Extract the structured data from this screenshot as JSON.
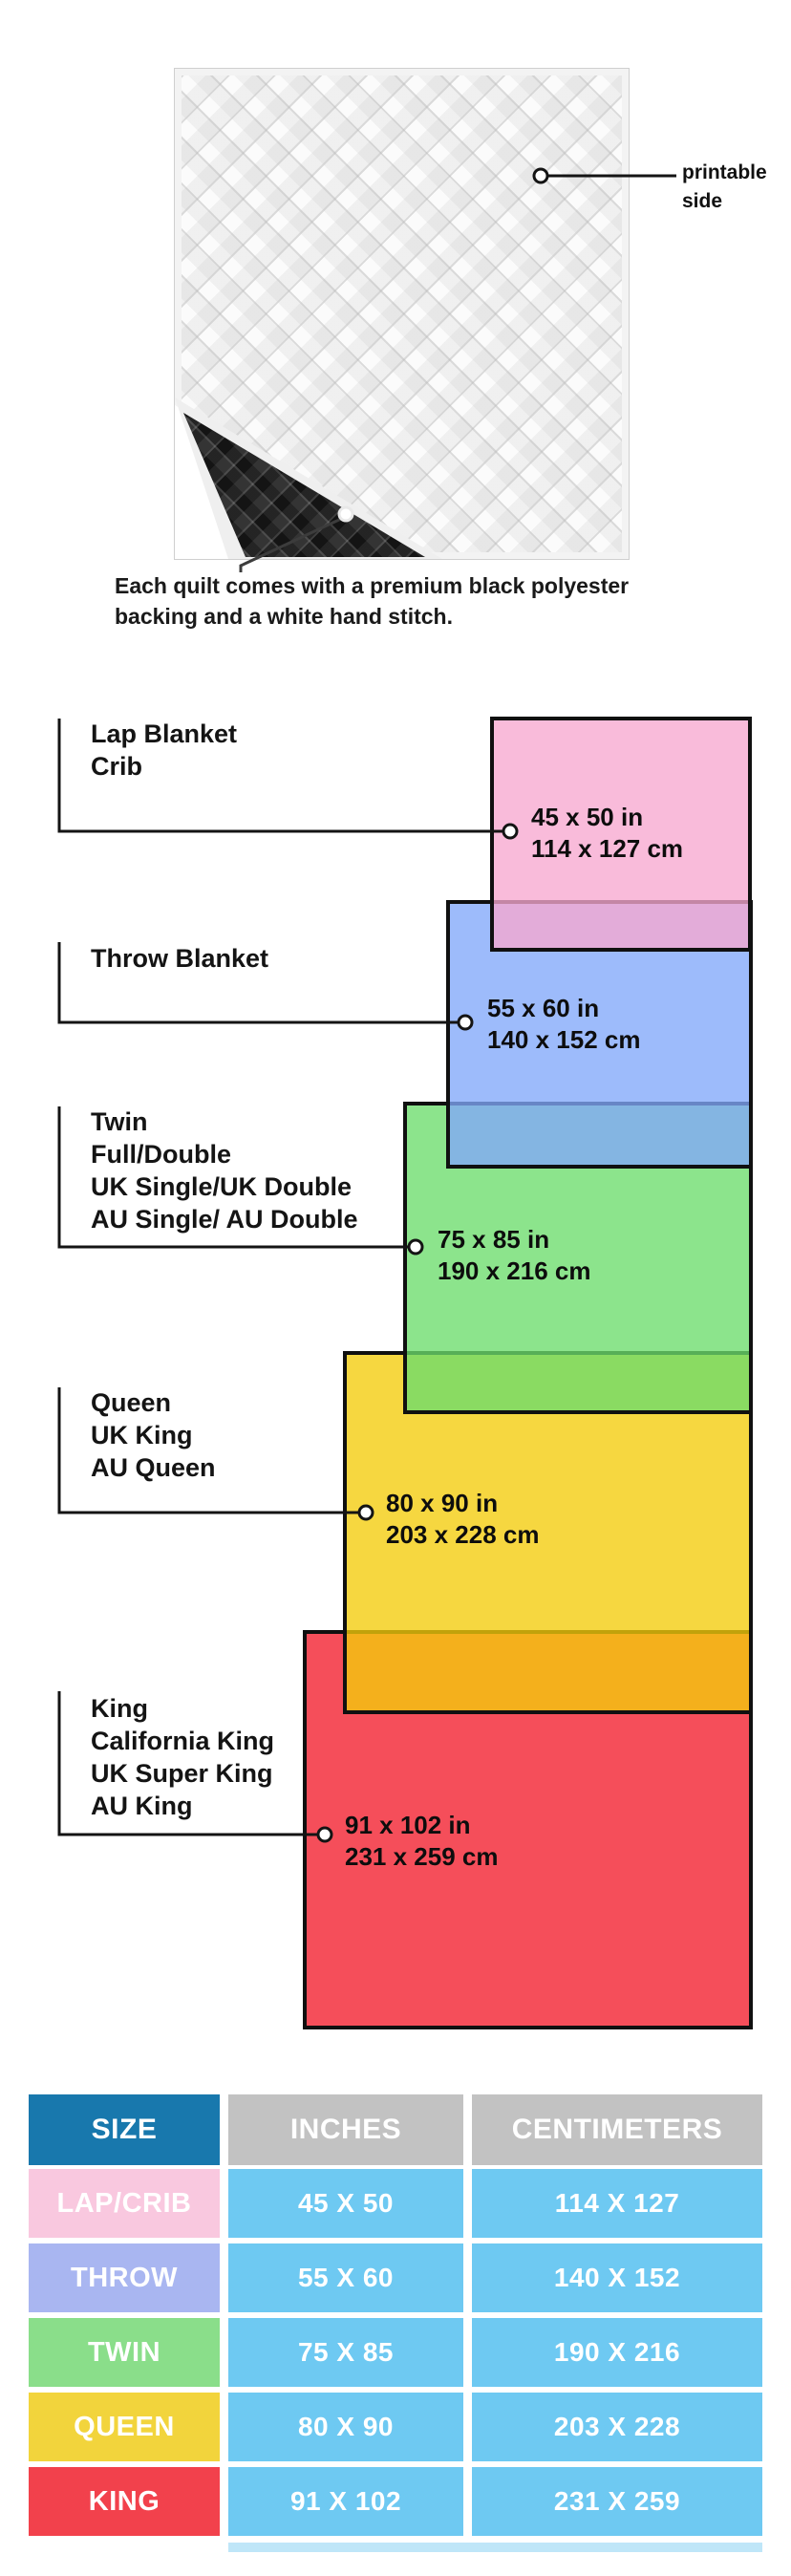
{
  "quilt": {
    "printable_label_line1": "printable",
    "printable_label_line2": "side",
    "caption_line1": "Each quilt comes with a premium black polyester",
    "caption_line2": "backing and a white hand stitch."
  },
  "diagram": {
    "border_color": "#101010",
    "items": [
      {
        "label_lines": [
          "Lap Blanket",
          "Crib"
        ],
        "inches": "45 x 50 in",
        "cm": "114 x 127 cm",
        "color": "#F7A8CF"
      },
      {
        "label_lines": [
          "Throw Blanket"
        ],
        "inches": "55 x 60 in",
        "cm": "140 x 152 cm",
        "color": "#82A8FA"
      },
      {
        "label_lines": [
          "Twin",
          "Full/Double",
          "UK Single/UK Double",
          "AU Single/ AU Double"
        ],
        "inches": "75 x 85 in",
        "cm": "190 x 216 cm",
        "color": "#6CDC6C"
      },
      {
        "label_lines": [
          "Queen",
          "UK King",
          "AU Queen"
        ],
        "inches": "80 x 90 in",
        "cm": "203 x 228 cm",
        "color": "#F3CC0A"
      },
      {
        "label_lines": [
          "King",
          "California King",
          "UK Super King",
          "AU King"
        ],
        "inches": "91 x 102 in",
        "cm": "231 x 259 cm",
        "color": "#F21C2C"
      }
    ]
  },
  "table": {
    "headers": [
      "SIZE",
      "INCHES",
      "CENTIMETERS"
    ],
    "header_colors": {
      "size": "#1878AD",
      "other": "#C2C2C2"
    },
    "cell_color": "#6EC9F2",
    "strip_color": "#BFE6F8",
    "rows": [
      {
        "size": "LAP/CRIB",
        "inches": "45 X 50",
        "cm": "114 X 127",
        "color": "#F9C8DF"
      },
      {
        "size": "THROW",
        "inches": "55 X 60",
        "cm": "140 X 152",
        "color": "#A9B6F1"
      },
      {
        "size": "TWIN",
        "inches": "75 X 85",
        "cm": "190 X 216",
        "color": "#8ADE8A"
      },
      {
        "size": "QUEEN",
        "inches": "80 X 90",
        "cm": "203 X 228",
        "color": "#F2D43C"
      },
      {
        "size": "KING",
        "inches": "91 X 102",
        "cm": "231 X 259",
        "color": "#F2414C"
      }
    ]
  }
}
